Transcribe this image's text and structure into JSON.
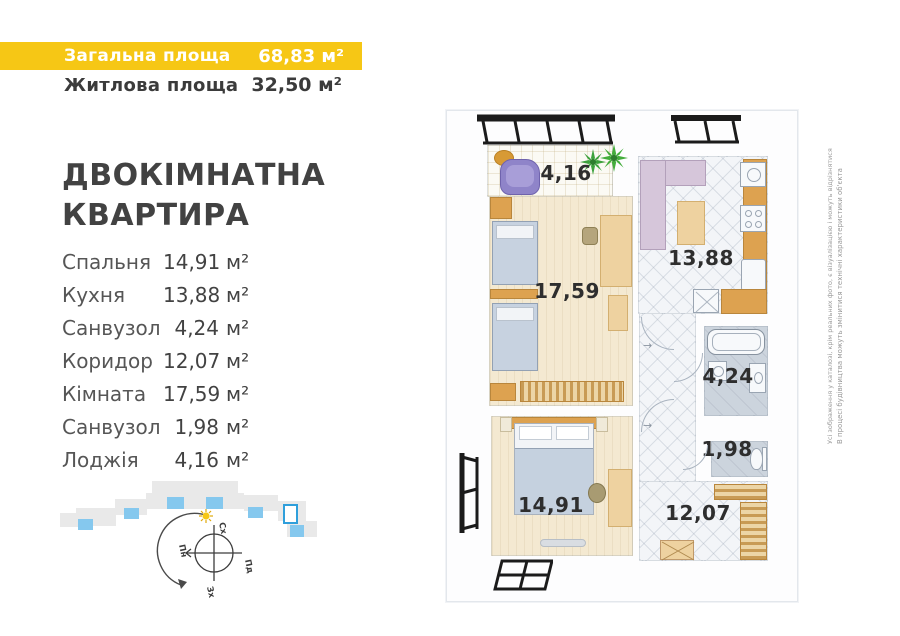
{
  "colors": {
    "accent_yellow": "#f6c715",
    "text_dark": "#3b3b3b",
    "site_blue": "#85c8ee",
    "highlight_blue": "#2f9fdb"
  },
  "header": {
    "total_label": "Загальна площа",
    "total_value": "68,83 м²",
    "living_label": "Житлова площа",
    "living_value": "32,50 м²"
  },
  "title": {
    "line1": "ДВОКІМНАТНА",
    "line2": "КВАРТИРА"
  },
  "room_list": [
    {
      "name": "Спальня",
      "num": "14,91",
      "unit": "м²"
    },
    {
      "name": "Кухня",
      "num": "13,88",
      "unit": "м²"
    },
    {
      "name": "Санвузол",
      "num": "4,24",
      "unit": "м²"
    },
    {
      "name": "Коридор",
      "num": "12,07",
      "unit": "м²"
    },
    {
      "name": "Кімната",
      "num": "17,59",
      "unit": "м²"
    },
    {
      "name": "Санвузол",
      "num": "1,98",
      "unit": "м²"
    },
    {
      "name": "Лоджія",
      "num": "4,16",
      "unit": "м²"
    }
  ],
  "plan_labels": {
    "loggia": "4,16",
    "living": "17,59",
    "kitchen": "13,88",
    "bathroom": "4,24",
    "wc": "1,98",
    "bedroom": "14,91",
    "corridor": "12,07"
  },
  "compass": {
    "north": "Пн",
    "south": "Пд",
    "east": "Сх",
    "west": "Зх"
  },
  "disclaimer": {
    "note_images": "Усі зображення у каталозі, крім реальних фото, є візуалізацією і можуть відрізнятися",
    "note_construction": "В процесі будівництва можуть змінитися технічні характеристики об'єкта"
  },
  "site_plan": {
    "blocks": [
      {
        "x": 112,
        "y": 6,
        "w": 86,
        "h": 12,
        "c": "gray"
      },
      {
        "x": 106,
        "y": 18,
        "w": 98,
        "h": 16,
        "c": "gray"
      },
      {
        "x": 75,
        "y": 24,
        "w": 32,
        "h": 16,
        "c": "gray"
      },
      {
        "x": 36,
        "y": 33,
        "w": 40,
        "h": 18,
        "c": "gray"
      },
      {
        "x": 20,
        "y": 38,
        "w": 18,
        "h": 14,
        "c": "gray"
      },
      {
        "x": 204,
        "y": 20,
        "w": 34,
        "h": 16,
        "c": "gray"
      },
      {
        "x": 238,
        "y": 26,
        "w": 28,
        "h": 20,
        "c": "gray"
      },
      {
        "x": 247,
        "y": 46,
        "w": 30,
        "h": 16,
        "c": "gray"
      },
      {
        "x": 127,
        "y": 22,
        "w": 17,
        "h": 12,
        "c": "blue"
      },
      {
        "x": 166,
        "y": 22,
        "w": 17,
        "h": 12,
        "c": "blue"
      },
      {
        "x": 84,
        "y": 33,
        "w": 15,
        "h": 11,
        "c": "blue"
      },
      {
        "x": 38,
        "y": 44,
        "w": 15,
        "h": 11,
        "c": "blue"
      },
      {
        "x": 208,
        "y": 32,
        "w": 15,
        "h": 11,
        "c": "blue"
      },
      {
        "x": 250,
        "y": 50,
        "w": 14,
        "h": 12,
        "c": "blue"
      }
    ],
    "highlight": {
      "x": 243,
      "y": 29,
      "w": 15,
      "h": 20
    }
  }
}
